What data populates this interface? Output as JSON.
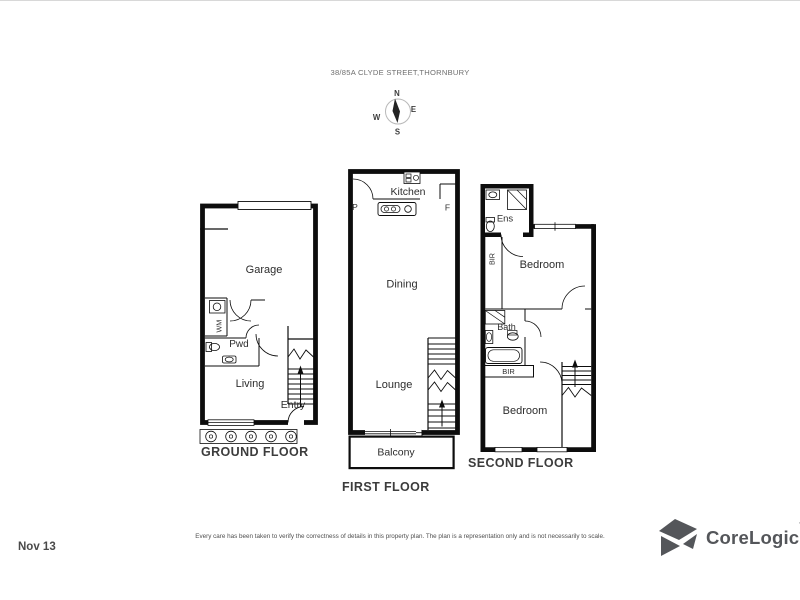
{
  "title": "38/85A CLYDE STREET,THORNBURY",
  "compass": {
    "north": "N",
    "east": "E",
    "south": "S",
    "west": "W"
  },
  "floors": {
    "ground": {
      "label": "GROUND FLOOR",
      "rooms": {
        "garage": "Garage",
        "laundry": "WM",
        "powder": "Pwd",
        "living": "Living",
        "entry": "Entry"
      }
    },
    "first": {
      "label": "FIRST FLOOR",
      "rooms": {
        "kitchen": "Kitchen",
        "pantry": "P",
        "fridge": "F",
        "dining": "Dining",
        "lounge": "Lounge",
        "balcony": "Balcony"
      }
    },
    "second": {
      "label": "SECOND FLOOR",
      "rooms": {
        "ensuite": "Ens",
        "robe_upper": "BIR",
        "bedroom_upper": "Bedroom",
        "bath": "Bath",
        "robe_lower": "BIR",
        "bedroom_lower": "Bedroom"
      }
    }
  },
  "footer": {
    "disclaimer": "Every care has been taken to verify the correctness of details in this property plan. The plan is a representation only and is not necessarily to scale.",
    "date": "Nov 13",
    "brand": "CoreLogic",
    "trademark": "'"
  },
  "colors": {
    "wall": "#0d0d0d",
    "label": "#3c3c3c",
    "brand": "#54565a"
  }
}
